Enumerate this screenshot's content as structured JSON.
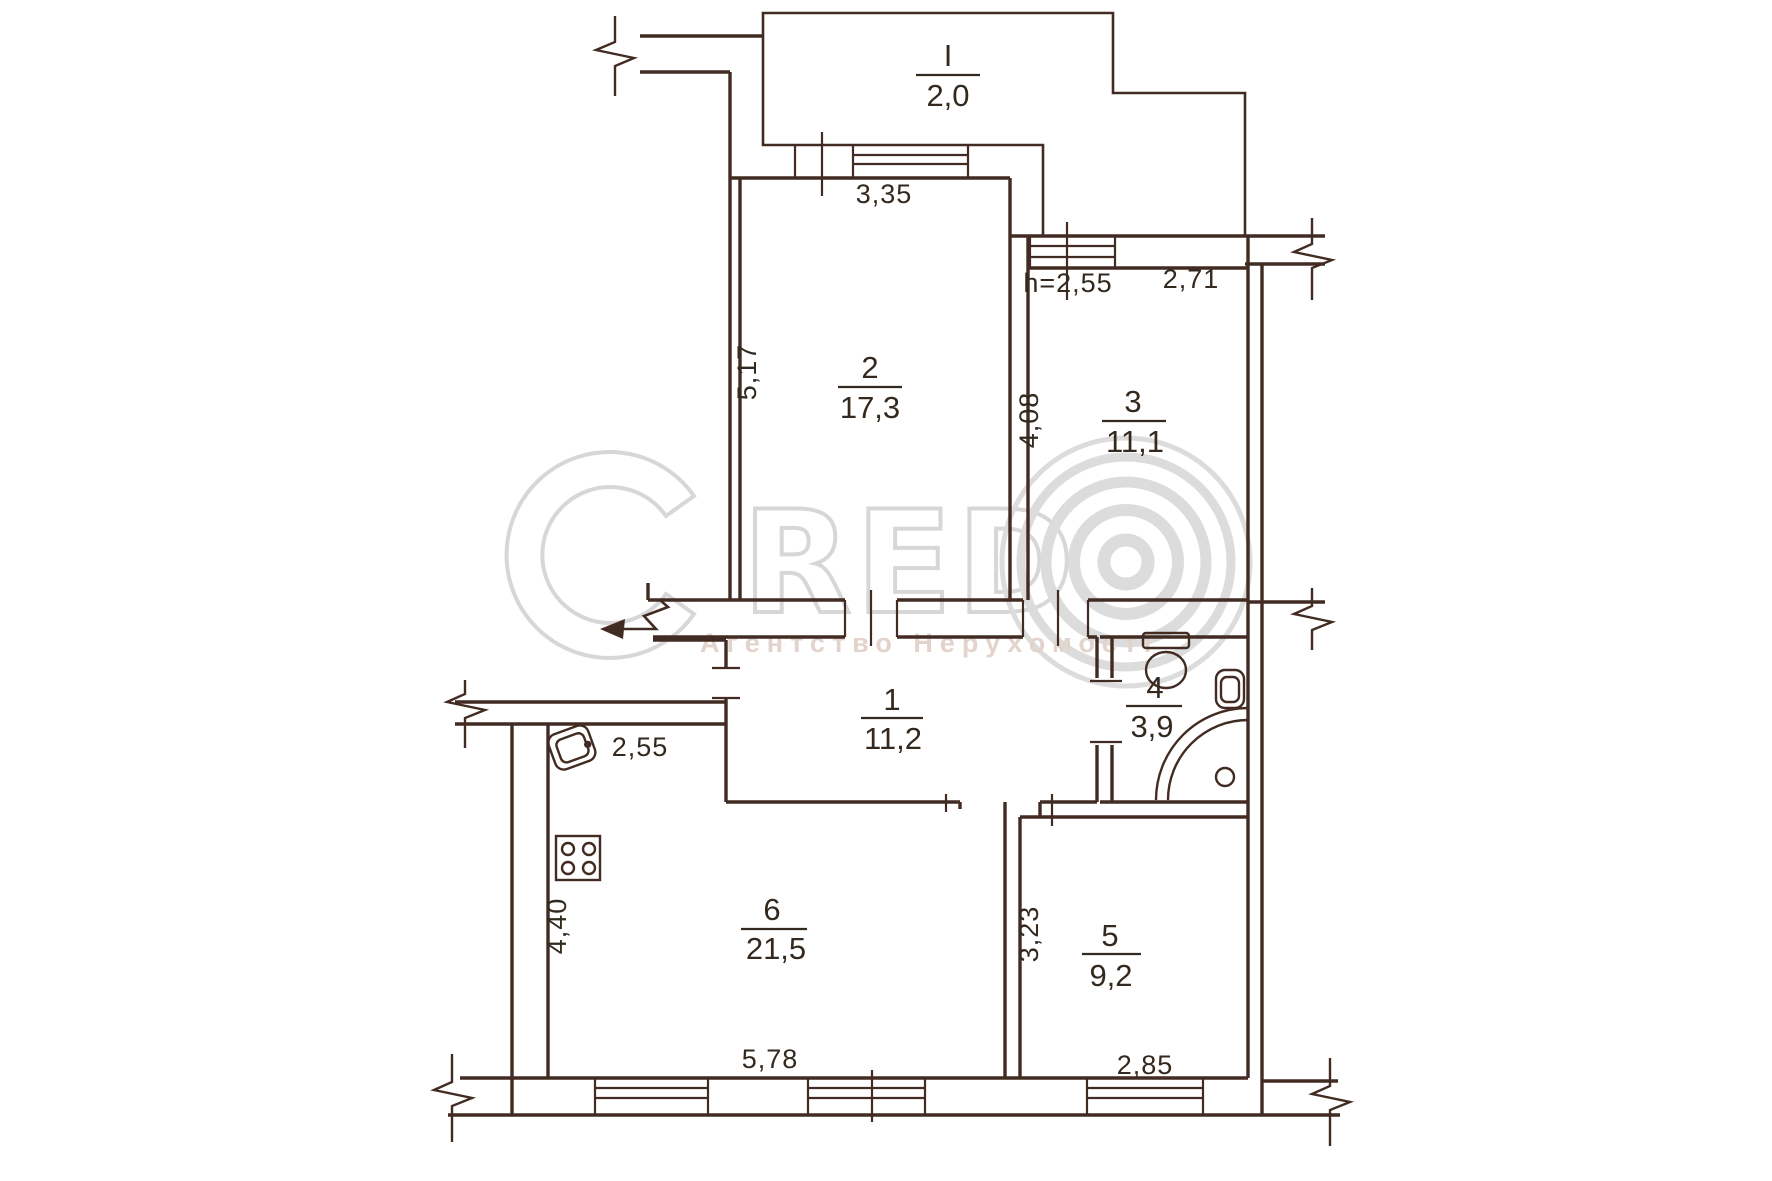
{
  "plan": {
    "type": "apartment-floor-plan",
    "rooms": {
      "balcony": {
        "num": "I",
        "area": "2,0"
      },
      "r1": {
        "num": "1",
        "area": "11,2"
      },
      "r2": {
        "num": "2",
        "area": "17,3"
      },
      "r3": {
        "num": "3",
        "area": "11,1"
      },
      "r4": {
        "num": "4",
        "area": "3,9"
      },
      "r5": {
        "num": "5",
        "area": "9,2"
      },
      "r6": {
        "num": "6",
        "area": "21,5"
      }
    },
    "dims": {
      "balcony_window_width": "3,35",
      "room2_depth": "5,17",
      "ceiling_height": "h=2,55",
      "room3_width": "2,71",
      "room3_depth": "4,08",
      "kitchen_top_width": "2,55",
      "kitchen_depth": "4,40",
      "kitchen_width": "5,78",
      "room5_depth": "3,23",
      "room5_width": "2,85"
    },
    "fixtures": [
      "toilet",
      "washbasin",
      "shower",
      "kitchen-sink",
      "stove"
    ],
    "colors": {
      "wall_line": "#422b22",
      "label_text": "#33291f",
      "watermark": "#d7d7d7",
      "watermark_subtitle": "#e2d4cc",
      "background": "#ffffff"
    }
  },
  "watermark": {
    "letters": "RED",
    "subtitle": "Агентство Нерухомості"
  }
}
